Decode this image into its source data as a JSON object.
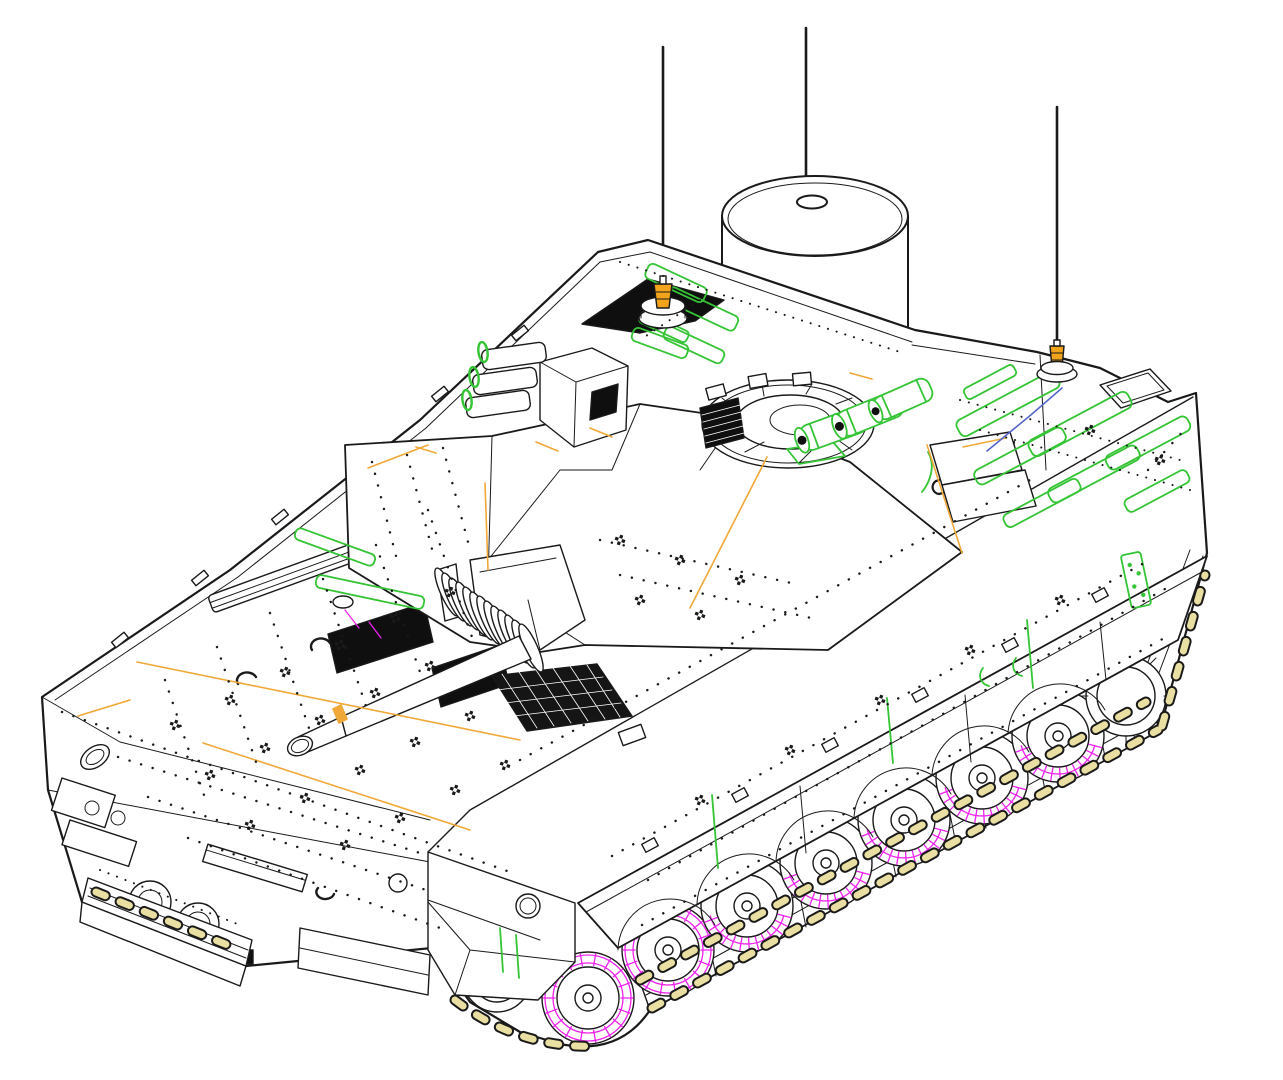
{
  "figure": {
    "type": "isometric technical line drawing",
    "subject": "tracked armored fighting vehicle with roof-mounted cylindrical radar drum, autocannon turret, smoke-grenade launchers and whip antennas",
    "antenna_count": 3,
    "road_wheel_count": 7,
    "smoke_launcher_tubes_left": 3,
    "smoke_launcher_tubes_right": 3
  },
  "palette": {
    "background": "#ffffff",
    "line": "#1a1a1a",
    "accent_green": "#35c435",
    "accent_magenta": "#ee22ee",
    "accent_orange": "#f0a838",
    "accent_amber": "#f2a41c",
    "accent_khaki": "#eadfa2",
    "accent_blue": "#5566cc",
    "dark_fill": "#0f0f0f",
    "white": "#ffffff"
  }
}
